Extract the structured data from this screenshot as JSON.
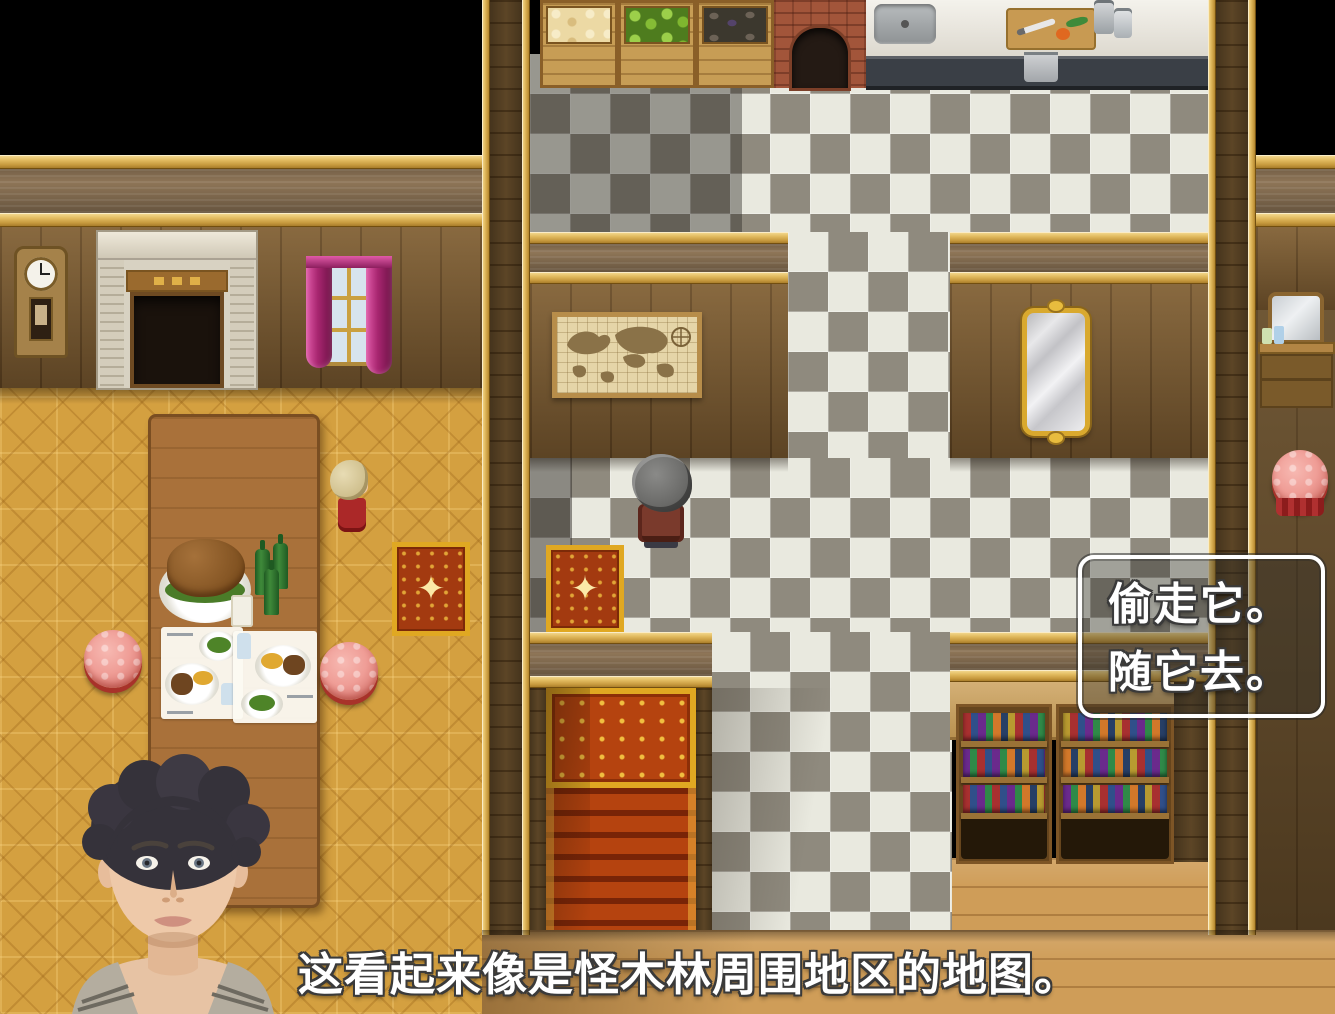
{
  "game": {
    "choice_menu": {
      "options": [
        "偷走它。",
        "随它去。"
      ]
    },
    "dialogue": {
      "text": "这看起来像是怪木林周围地区的地图。"
    },
    "rug_star_glyph": "✦"
  },
  "colors": {
    "void": "#000000",
    "gold_frame": "#e3bc62",
    "wood_wall": "#7b5a30",
    "wall_beam": "#8e7557",
    "parquet_floor": "#d4a040",
    "tile_light": "#e9e9df",
    "tile_dark": "#8f8a7e",
    "light_floor": "#cf9d58",
    "carpet_red": "#b5430f",
    "carpet_gold": "#e0a822",
    "choice_border": "#ffffff",
    "choice_background": "rgba(46,44,40,0.38)",
    "text_color": "#ffffff",
    "text_outline": "#3a3a3a"
  }
}
